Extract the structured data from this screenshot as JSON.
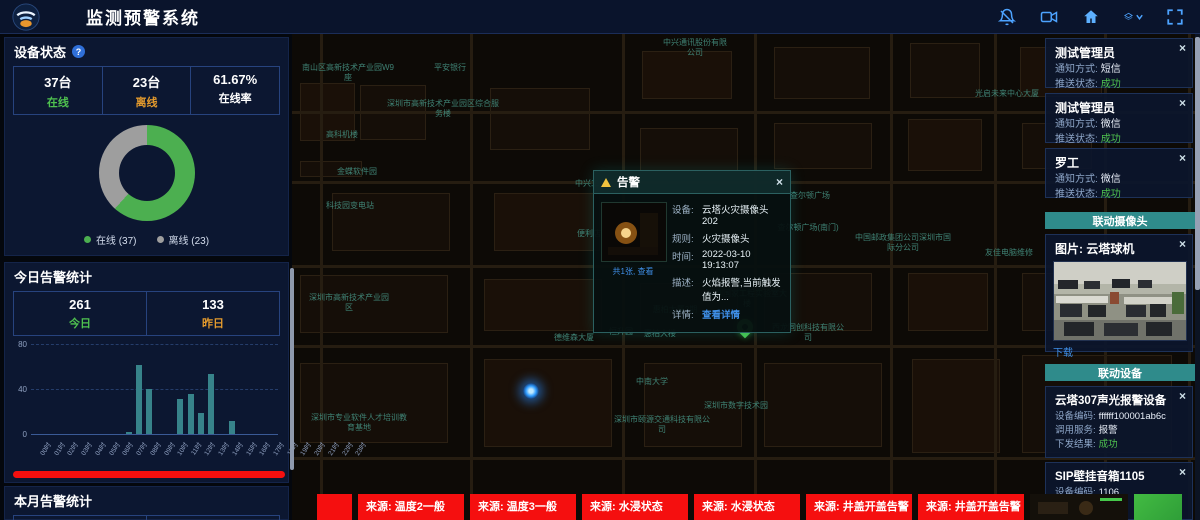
{
  "header": {
    "title": "监测预警系统",
    "icons": [
      {
        "name": "bell-muted-icon"
      },
      {
        "name": "video-camera-icon"
      },
      {
        "name": "home-icon"
      },
      {
        "name": "layers-icon"
      },
      {
        "name": "fullscreen-icon"
      }
    ]
  },
  "device_status": {
    "title": "设备状态",
    "stats": [
      {
        "value": "37台",
        "label": "在线",
        "color": "#4fc24f"
      },
      {
        "value": "23台",
        "label": "离线",
        "color": "#e39a2d"
      },
      {
        "value": "61.67%",
        "label": "在线率",
        "color": "#ffffff"
      }
    ],
    "chart_data": {
      "type": "pie",
      "labels": [
        "在线",
        "离线"
      ],
      "values": [
        37,
        23
      ],
      "colors": [
        "#4caf50",
        "#9e9e9e"
      ]
    },
    "legend": [
      {
        "label": "在线 (37)",
        "color": "#4caf50"
      },
      {
        "label": "离线 (23)",
        "color": "#9e9e9e"
      }
    ]
  },
  "today_alarms": {
    "title": "今日告警统计",
    "stats": [
      {
        "value": "261",
        "label": "今日",
        "color": "#4fc24f"
      },
      {
        "value": "133",
        "label": "昨日",
        "color": "#e39a2d"
      }
    ],
    "chart_data": {
      "type": "bar",
      "categories": [
        "00时",
        "01时",
        "02时",
        "03时",
        "04时",
        "05时",
        "06时",
        "07时",
        "08时",
        "09时",
        "10时",
        "11时",
        "12时",
        "13时",
        "14时",
        "15时",
        "16时",
        "17时",
        "18时",
        "19时",
        "20时",
        "21时",
        "22时",
        "23时"
      ],
      "values": [
        0,
        0,
        0,
        0,
        0,
        0,
        0,
        0,
        0,
        2,
        61,
        40,
        0,
        0,
        31,
        36,
        19,
        53,
        0,
        12,
        0,
        0,
        0,
        0
      ],
      "ylim": [
        0,
        80
      ],
      "yticks": [
        "80",
        "40",
        "0"
      ],
      "bar_color": "#37838a",
      "grid": "dashed"
    }
  },
  "progress": {
    "unprocessed": {
      "label": "未处理(261个)",
      "color": "#f50f0f"
    },
    "processed": {
      "label": "已处理(0个)",
      "color": "#4fc24f"
    },
    "percent_unprocessed": 100
  },
  "month_alarms": {
    "title": "本月告警统计",
    "stats": [
      {
        "value": "763"
      },
      {
        "value": "1146"
      }
    ]
  },
  "map": {
    "labels": [
      {
        "text": "南山区高新技术产业园W9座",
        "x": 10,
        "y": 30,
        "w": 92
      },
      {
        "text": "平安银行",
        "x": 128,
        "y": 30,
        "w": 60
      },
      {
        "text": "中兴通讯股份有限公司",
        "x": 368,
        "y": 5,
        "w": 70
      },
      {
        "text": "光启未来中心大厦",
        "x": 660,
        "y": 56,
        "w": 110
      },
      {
        "text": "深圳市高新技术产业园区综合服务楼",
        "x": 92,
        "y": 66,
        "w": 118
      },
      {
        "text": "高科机楼",
        "x": 20,
        "y": 97,
        "w": 60
      },
      {
        "text": "金蝶软件园",
        "x": 30,
        "y": 134,
        "w": 70
      },
      {
        "text": "科技园变电站",
        "x": 18,
        "y": 168,
        "w": 80
      },
      {
        "text": "中兴工业园",
        "x": 268,
        "y": 146,
        "w": 70
      },
      {
        "text": "便利店",
        "x": 272,
        "y": 196,
        "w": 50
      },
      {
        "text": "查尔顿广场",
        "x": 483,
        "y": 158,
        "w": 70
      },
      {
        "text": "查尔顿广场(南门)",
        "x": 476,
        "y": 190,
        "w": 80
      },
      {
        "text": "中国邮政集团公司深圳市国际分公司",
        "x": 563,
        "y": 200,
        "w": 96
      },
      {
        "text": "友佳电脑维修",
        "x": 686,
        "y": 215,
        "w": 62
      },
      {
        "text": "深圳市高新技术产业园区",
        "x": 14,
        "y": 260,
        "w": 86
      },
      {
        "text": "深圳国家工程实验室大楼",
        "x": 412,
        "y": 256,
        "w": 86
      },
      {
        "text": "惠柏大厦2期",
        "x": 345,
        "y": 272,
        "w": 76
      },
      {
        "text": "恒升园",
        "x": 308,
        "y": 294,
        "w": 42
      },
      {
        "text": "惠柏大楼",
        "x": 338,
        "y": 296,
        "w": 60
      },
      {
        "text": "德维森大厦",
        "x": 246,
        "y": 300,
        "w": 72
      },
      {
        "text": "西龙同创科技有限公司",
        "x": 478,
        "y": 290,
        "w": 76
      },
      {
        "text": "中南大学",
        "x": 330,
        "y": 344,
        "w": 60
      },
      {
        "text": "深圳市数字技术园",
        "x": 396,
        "y": 368,
        "w": 96
      },
      {
        "text": "深圳市颐源交通科技有限公司",
        "x": 322,
        "y": 382,
        "w": 96
      },
      {
        "text": "深圳市专业软件人才培训教育基地",
        "x": 16,
        "y": 380,
        "w": 102
      }
    ],
    "markers": [
      {
        "name": "device-location-marker",
        "type": "blue-dot"
      },
      {
        "name": "alert-location-pin",
        "type": "green-pin"
      }
    ],
    "popup": {
      "title": "告警",
      "thumbnail_caption": "共1张, 查看",
      "fields": [
        {
          "label": "设备:",
          "value": "云塔火灾摄像头202"
        },
        {
          "label": "规则:",
          "value": "火灾摄像头"
        },
        {
          "label": "时间:",
          "value": "2022-03-10 19:13:07"
        },
        {
          "label": "描述:",
          "value": "火焰报警,当前触发值为..."
        },
        {
          "label": "详情:",
          "value": "查看详情",
          "link": true
        }
      ]
    }
  },
  "notifications": [
    {
      "name": "测试管理员",
      "fields": [
        {
          "label": "通知方式:",
          "value": "短信"
        },
        {
          "label": "推送状态:",
          "value": "成功",
          "status": true
        }
      ]
    },
    {
      "name": "测试管理员",
      "fields": [
        {
          "label": "通知方式:",
          "value": "微信"
        },
        {
          "label": "推送状态:",
          "value": "成功",
          "status": true
        }
      ]
    },
    {
      "name": "罗工",
      "fields": [
        {
          "label": "通知方式:",
          "value": "微信"
        },
        {
          "label": "推送状态:",
          "value": "成功",
          "status": true
        }
      ]
    }
  ],
  "camera_section": {
    "header": "联动摄像头",
    "card": {
      "title": "图片: 云塔球机",
      "download_label": "下载"
    }
  },
  "device_section": {
    "header": "联动设备",
    "cards": [
      {
        "name": "云塔307声光报警设备",
        "fields": [
          {
            "label": "设备编码:",
            "value": "ffffff100001ab6c"
          },
          {
            "label": "调用服务:",
            "value": "报警"
          },
          {
            "label": "下发结果:",
            "value": "成功",
            "status": true
          }
        ]
      },
      {
        "name": "SIP壁挂音箱1105",
        "fields": [
          {
            "label": "设备编码:",
            "value": "1106"
          }
        ]
      }
    ]
  },
  "ticker": {
    "color": "#f50f0f",
    "items": [
      {
        "type": "block"
      },
      {
        "type": "text",
        "label": "来源: 温度2一般"
      },
      {
        "type": "text",
        "label": "来源: 温度3一般"
      },
      {
        "type": "text",
        "label": "来源: 水浸状态"
      },
      {
        "type": "text",
        "label": "来源: 水浸状态"
      },
      {
        "type": "text",
        "label": "来源: 井盖开盖告警"
      },
      {
        "type": "text",
        "label": "来源: 井盖开盖告警"
      },
      {
        "type": "image",
        "variant": "dark"
      },
      {
        "type": "image",
        "variant": "green"
      }
    ]
  }
}
